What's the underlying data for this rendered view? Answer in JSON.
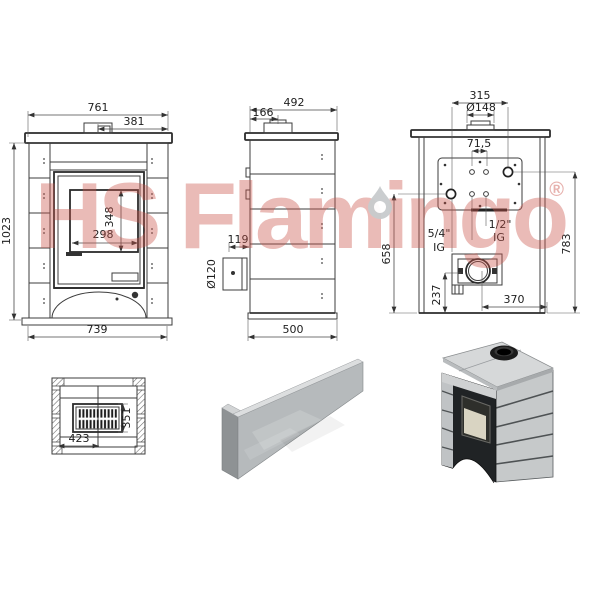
{
  "watermark": {
    "brand": "HS Flamingo",
    "registered": "®"
  },
  "views": {
    "front": {
      "overall_width": "761",
      "half_width": "381",
      "overall_height": "1023",
      "glass_height": "348",
      "glass_width": "298",
      "base_width": "739"
    },
    "side": {
      "overall_depth": "492",
      "flue_center_offset": "166",
      "rear_outlet_offset": "119",
      "flue_diameter": "Ø120",
      "base_depth": "500"
    },
    "back": {
      "flue_center_span": "315",
      "collar_diameter": "Ø148",
      "hole_spacing": "71,5",
      "fitting_small_size": "1/2\"",
      "fitting_small_thread": "IG",
      "fitting_large_size": "5/4\"",
      "fitting_large_thread": "IG",
      "height_to_lower_fitting": "658",
      "height_to_upper_fitting": "783",
      "outlet_height": "237",
      "outlet_offset": "370"
    },
    "top": {
      "inner_width": "423",
      "grate_depth": "351"
    }
  }
}
